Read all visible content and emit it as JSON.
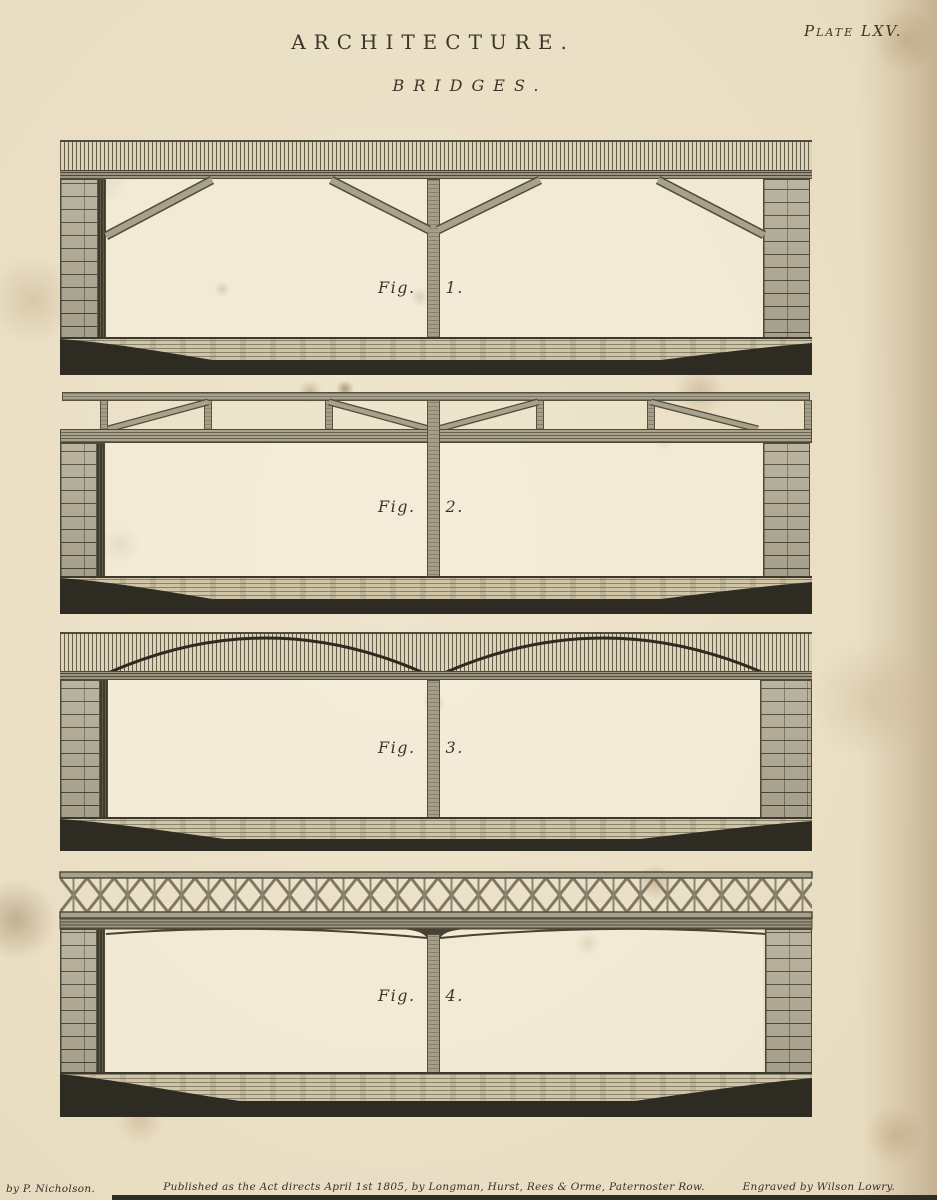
{
  "page": {
    "title": "ARCHITECTURE.",
    "subtitle": "BRIDGES.",
    "plate_ref": "Plate LXV.",
    "imprint": {
      "author_credit": "by P. Nicholson.",
      "publication": "Published as the Act directs April 1st 1805, by Longman, Hurst, Rees & Orme, Paternoster Row.",
      "engraver_credit": "Engraved by Wilson Lowry."
    }
  },
  "figures": [
    {
      "prefix": "Fig.",
      "number": "1."
    },
    {
      "prefix": "Fig.",
      "number": "2."
    },
    {
      "prefix": "Fig.",
      "number": "3."
    },
    {
      "prefix": "Fig.",
      "number": "4."
    }
  ],
  "colors": {
    "paper": "#e8dcc0",
    "ink": "#3b352a",
    "timber_member": "#a8a18b",
    "member_edge": "#514c3a",
    "masonry": "#b2ab95",
    "river_bank": "#2e2b22",
    "water": "#cfc5a6"
  }
}
